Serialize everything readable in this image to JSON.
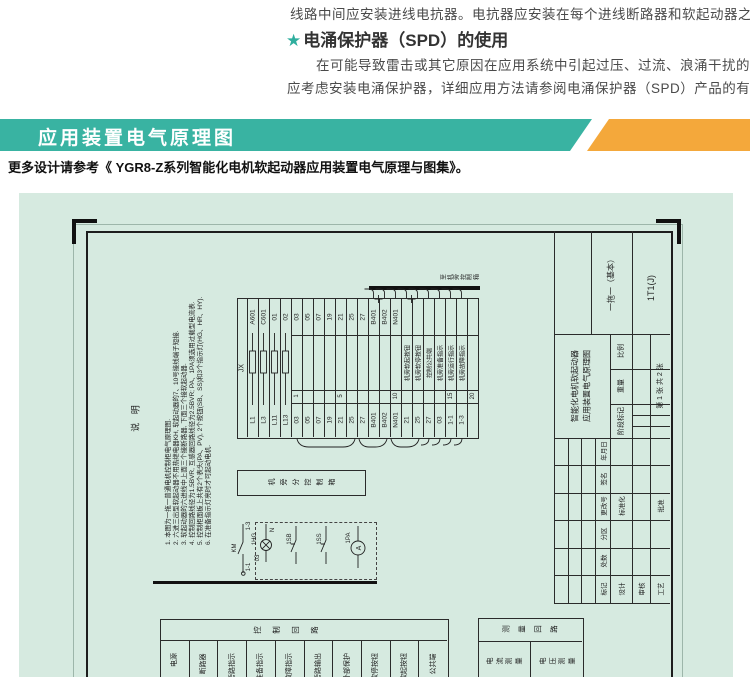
{
  "page": {
    "intro_line": "线路中间应安装进线电抗器。电抗器应安装在每个进线断路器和软起动器之间。",
    "spd_star": "★",
    "spd_heading": "电涌保护器（SPD）的使用",
    "spd_para_line1": "在可能导致雷击或其它原因在应用系统中引起过压、过流、浪涌干扰的场所",
    "spd_para_line2": "应考虑安装电涌保护器，详细应用方法请参阅电涌保护器（SPD）产品的有关资料。",
    "banner_title": "应用装置电气原理图",
    "caption": "更多设计请参考《 YGR8-Z系列智能化电机软起动器应用装置电气原理与图集》。"
  },
  "colors": {
    "teal": "#39b3a2",
    "orange": "#f4a83b",
    "panel_green": "#d6eae0",
    "line": "#2b2b2b"
  },
  "drawing": {
    "notes": {
      "title": "说 明",
      "items": [
        "1. 本图为一拖一普通电机控制柜电气原理图.",
        "2. 六进三出型软起动器不用热继电器KH, 软起动器的7、10号接线端子短接.",
        "3. 软起动器的六进线中上面三个接断路器, 下面三个接软起动器.",
        "4. 控制回路线径为1.5BVR, 互感器回路线径为2.5BVR; PA、1PA须选用过载型电流表.",
        "5. 控制柜面板上共有2个表头(PA、PV), 2个按钮(SB、SS)和3个指示灯(HG、HR、HY).",
        "6. 在准备指示灯亮时才可起动电机."
      ]
    },
    "terminal_table": {
      "name": "JX",
      "columns": [
        {
          "top": "A601",
          "bottom": "L1",
          "fuse": true
        },
        {
          "top": "C601",
          "bottom": "L3",
          "fuse": true
        },
        {
          "top": "01",
          "bottom": "L11",
          "fuse": true
        },
        {
          "top": "02",
          "bottom": "L13",
          "fuse": true
        },
        {
          "top": "03",
          "bottom": "03",
          "tick": "1"
        },
        {
          "top": "05",
          "bottom": "05"
        },
        {
          "top": "07",
          "bottom": "07"
        },
        {
          "top": "19",
          "bottom": "19"
        },
        {
          "top": "21",
          "bottom": "21",
          "tick": "5"
        },
        {
          "top": "25",
          "bottom": "25"
        },
        {
          "top": "27",
          "bottom": "27"
        },
        {
          "top": "B401",
          "bottom": "B401",
          "up": true,
          "plus": true
        },
        {
          "top": "B402",
          "bottom": "B402",
          "up": true
        },
        {
          "top": "N401",
          "bottom": "N401",
          "tick": "10",
          "up": true
        },
        {
          "bottom": "21",
          "desc": "机旁软起按钮",
          "up": true,
          "plus": true
        },
        {
          "bottom": "25",
          "desc": "机旁软停按钮",
          "up": true
        },
        {
          "bottom": "27",
          "desc": "控制公共端",
          "up": true
        },
        {
          "bottom": "03",
          "desc": "机旁准备指示",
          "up": true
        },
        {
          "bottom": "1-1",
          "desc": "机旁运行指示",
          "tick": "15",
          "up": true
        },
        {
          "bottom": "1-3",
          "desc": "机旁故障指示",
          "up": true
        },
        {
          "bottom": "",
          "tick": "20"
        }
      ]
    },
    "to_box_label": "至机旁控制箱",
    "sub_box_label": "机旁分控制箱",
    "detail": {
      "t13": "1-3",
      "km": "KM",
      "t11": "1-1",
      "lamp": "1HG",
      "lamp_top": "N",
      "lamp_bottom": "03",
      "btn1": "1SB",
      "btn2": "1SS",
      "meter": "1PA",
      "meter_symbol": "A"
    },
    "control_table": {
      "header": "控制回路",
      "columns": [
        "电源",
        "断路器",
        "旁路指示",
        "准备指示",
        "故障指示",
        "旁路输出",
        "外部保护",
        "软停按钮",
        "软起按钮",
        "公共端"
      ]
    },
    "measure_table": {
      "header": "测量回路",
      "cells": [
        "电流测量",
        "电压测量"
      ]
    },
    "title_block": {
      "project_line1": "智能化电机软起动器",
      "project_line2": "应用装置电气原理图",
      "scheme": "一拖一（基本）",
      "code": "1T1(J)",
      "scale_label": "比例",
      "weight_label": "重量",
      "stage_label": "阶段标记",
      "sheet_info": "第 1 张  共 2 张",
      "rev_headers": [
        "年月日",
        "签名",
        "更改号",
        "分区",
        "处数",
        "标记"
      ],
      "design": "设计",
      "standard": "标准化",
      "audit": "审核",
      "craft": "工艺",
      "approve": "批准"
    }
  }
}
